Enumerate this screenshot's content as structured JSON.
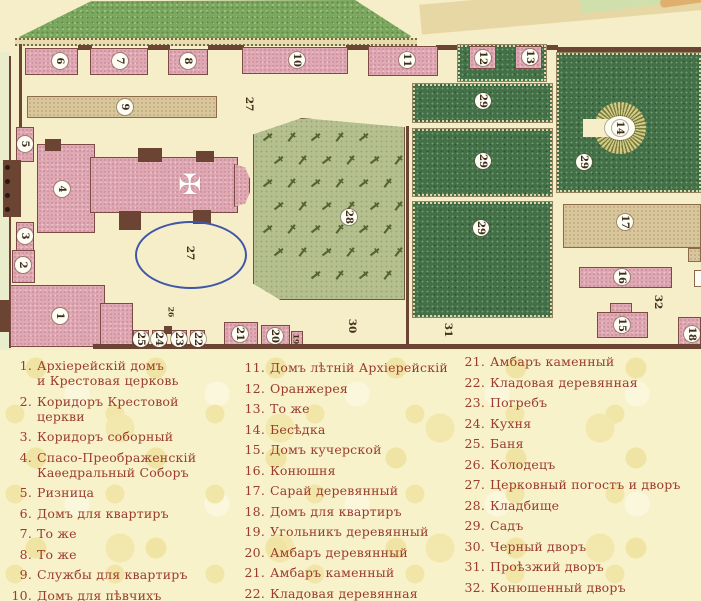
{
  "map": {
    "labels": [
      {
        "t": "6",
        "x": 60,
        "y": 61,
        "kind": "circle"
      },
      {
        "t": "7",
        "x": 120,
        "y": 61,
        "kind": "circle"
      },
      {
        "t": "8",
        "x": 188,
        "y": 61,
        "kind": "circle"
      },
      {
        "t": "10",
        "x": 297,
        "y": 60,
        "kind": "circle"
      },
      {
        "t": "11",
        "x": 407,
        "y": 60,
        "kind": "circle"
      },
      {
        "t": "12",
        "x": 483,
        "y": 58,
        "kind": "circle"
      },
      {
        "t": "13",
        "x": 530,
        "y": 57,
        "kind": "circle"
      },
      {
        "t": "9",
        "x": 125,
        "y": 107,
        "kind": "circle"
      },
      {
        "t": "5",
        "x": 25,
        "y": 144,
        "kind": "circle"
      },
      {
        "t": "4",
        "x": 62,
        "y": 189,
        "kind": "circle"
      },
      {
        "t": "3",
        "x": 25,
        "y": 236,
        "kind": "circle"
      },
      {
        "t": "2",
        "x": 23,
        "y": 265,
        "kind": "circle"
      },
      {
        "t": "1",
        "x": 60,
        "y": 316,
        "kind": "circle"
      },
      {
        "t": "25",
        "x": 141,
        "y": 339,
        "kind": "circle"
      },
      {
        "t": "24",
        "x": 159,
        "y": 339,
        "kind": "circle"
      },
      {
        "t": "23",
        "x": 179,
        "y": 339,
        "kind": "circle"
      },
      {
        "t": "22",
        "x": 198,
        "y": 339,
        "kind": "circle"
      },
      {
        "t": "21",
        "x": 240,
        "y": 334,
        "kind": "circle"
      },
      {
        "t": "20",
        "x": 275,
        "y": 336,
        "kind": "circle"
      },
      {
        "t": "28",
        "x": 349,
        "y": 217,
        "kind": "circle"
      },
      {
        "t": "29",
        "x": 483,
        "y": 101,
        "kind": "circle"
      },
      {
        "t": "29",
        "x": 483,
        "y": 161,
        "kind": "circle"
      },
      {
        "t": "29",
        "x": 481,
        "y": 228,
        "kind": "circle"
      },
      {
        "t": "29",
        "x": 584,
        "y": 162,
        "kind": "circle"
      },
      {
        "t": "14",
        "x": 620,
        "y": 128,
        "kind": "circle"
      },
      {
        "t": "17",
        "x": 625,
        "y": 222,
        "kind": "circle"
      },
      {
        "t": "16",
        "x": 622,
        "y": 277,
        "kind": "circle"
      },
      {
        "t": "15",
        "x": 622,
        "y": 325,
        "kind": "circle"
      },
      {
        "t": "18",
        "x": 692,
        "y": 334,
        "kind": "circle"
      },
      {
        "t": "27",
        "x": 249,
        "y": 104,
        "kind": "plain"
      },
      {
        "t": "27",
        "x": 190,
        "y": 253,
        "kind": "plain"
      },
      {
        "t": "26",
        "x": 171,
        "y": 312,
        "kind": "plain tiny"
      },
      {
        "t": "30",
        "x": 352,
        "y": 326,
        "kind": "plain"
      },
      {
        "t": "31",
        "x": 448,
        "y": 330,
        "kind": "plain"
      },
      {
        "t": "32",
        "x": 658,
        "y": 302,
        "kind": "plain"
      },
      {
        "t": "19",
        "x": 296,
        "y": 339,
        "kind": "plain tiny"
      }
    ],
    "cross_symbol": "✠"
  },
  "legend": {
    "columns": [
      {
        "items": [
          {
            "n": "1.",
            "lines": [
              "Архіерейскій домъ",
              "и Крестовая церковь"
            ]
          },
          {
            "n": "2.",
            "lines": [
              "Коридоръ Крестовой",
              "церкви"
            ]
          },
          {
            "n": "3.",
            "lines": [
              "Коридоръ соборный"
            ]
          },
          {
            "n": "4.",
            "lines": [
              "Спасо-Преображенскій",
              "Каѳедральный Соборъ"
            ]
          },
          {
            "n": "5.",
            "lines": [
              "Ризница"
            ]
          },
          {
            "n": "6.",
            "lines": [
              "Домъ для квартиръ"
            ]
          },
          {
            "n": "7.",
            "lines": [
              "То же"
            ]
          },
          {
            "n": "8.",
            "lines": [
              "То же"
            ]
          },
          {
            "n": "9.",
            "lines": [
              "Службы для квартиръ"
            ]
          },
          {
            "n": "10.",
            "lines": [
              "Домъ для пѣвчихъ"
            ]
          }
        ]
      },
      {
        "items": [
          {
            "n": "11.",
            "lines": [
              "Домъ лѣтній Архіерейскій"
            ]
          },
          {
            "n": "12.",
            "lines": [
              "Оранжерея"
            ]
          },
          {
            "n": "13.",
            "lines": [
              "То же"
            ]
          },
          {
            "n": "14.",
            "lines": [
              "Бесѣдка"
            ]
          },
          {
            "n": "15.",
            "lines": [
              "Домъ кучерской"
            ]
          },
          {
            "n": "16.",
            "lines": [
              "Конюшня"
            ]
          },
          {
            "n": "17.",
            "lines": [
              "Сарай деревянный"
            ]
          },
          {
            "n": "18.",
            "lines": [
              "Домъ для квартиръ"
            ]
          },
          {
            "n": "19.",
            "lines": [
              "Угольникъ деревянный"
            ]
          },
          {
            "n": "20.",
            "lines": [
              "Амбаръ деревянный"
            ]
          },
          {
            "n": "21.",
            "lines": [
              "Амбаръ каменный"
            ]
          },
          {
            "n": "22.",
            "lines": [
              "Кладовая деревянная"
            ]
          }
        ]
      },
      {
        "items": [
          {
            "n": "21.",
            "lines": [
              "Амбаръ каменный"
            ]
          },
          {
            "n": "22.",
            "lines": [
              "Кладовая деревянная"
            ]
          },
          {
            "n": "23.",
            "lines": [
              "Погребъ"
            ]
          },
          {
            "n": "24.",
            "lines": [
              "Кухня"
            ]
          },
          {
            "n": "25.",
            "lines": [
              "Баня"
            ]
          },
          {
            "n": "26.",
            "lines": [
              "Колодецъ"
            ]
          },
          {
            "n": "27.",
            "lines": [
              "Церковный погостъ и дворъ"
            ]
          },
          {
            "n": "28.",
            "lines": [
              "Кладбище"
            ]
          },
          {
            "n": "29.",
            "lines": [
              "Садъ"
            ]
          },
          {
            "n": "30.",
            "lines": [
              "Черный дворъ"
            ]
          },
          {
            "n": "31.",
            "lines": [
              "Проѣзжий дворъ"
            ]
          },
          {
            "n": "32.",
            "lines": [
              "Конюшенный дворъ"
            ]
          },
          {
            "n": "33.",
            "lines": [
              "Колодецъ"
            ]
          }
        ]
      }
    ]
  },
  "colors": {
    "map_background": "#f6eec9",
    "legend_background": "#f8f2cb",
    "legend_text": "#9a3b2b",
    "building_pink": "#dfa7b1",
    "building_tan": "#d8c69c",
    "wall_brown": "#6b4434",
    "garden_dark": "#447048",
    "garden_light": "#7ca75f",
    "cemetery": "#b5c08e",
    "ellipse_blue": "#4056a8"
  }
}
